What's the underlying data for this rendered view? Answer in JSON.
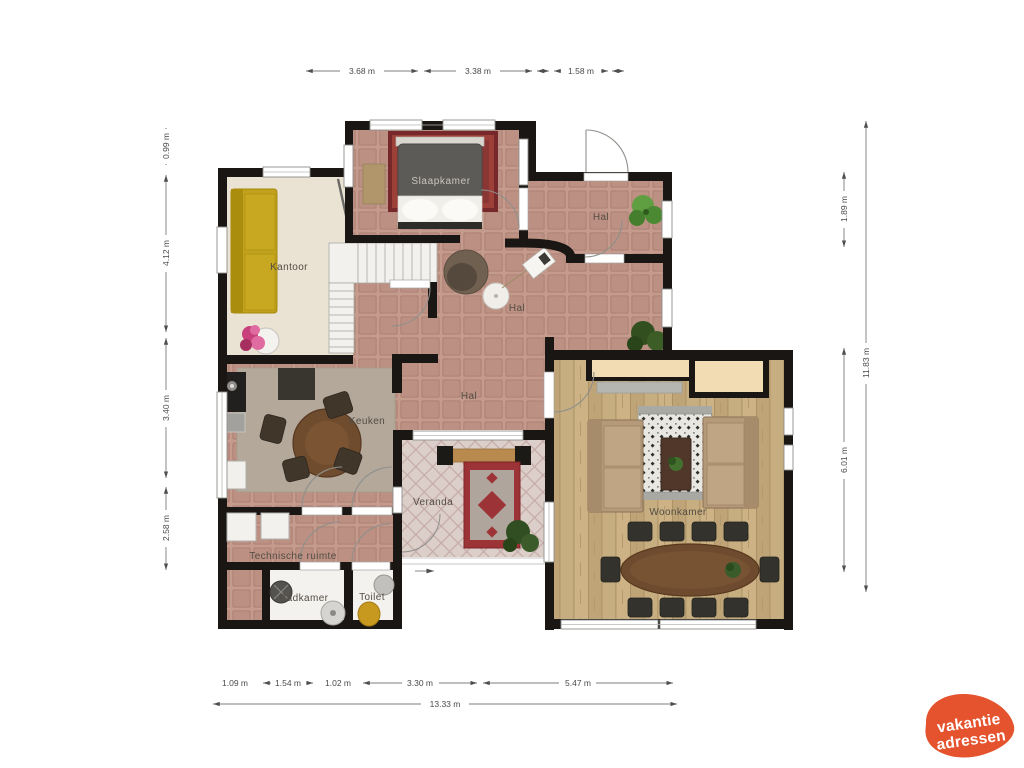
{
  "plan": {
    "rooms": {
      "slaapkamer": "Slaapkamer",
      "kantoor": "Kantoor",
      "hal_boven": "Hal",
      "hal_midden": "Hal",
      "hal_beneden": "Hal",
      "keuken": "Keuken",
      "veranda": "Veranda",
      "woonkamer": "Woonkamer",
      "technische_ruimte": "Technische ruimte",
      "badkamer": "Badkamer",
      "toilet": "Toilet"
    },
    "dimensions": {
      "top": [
        "3.68 m",
        "3.38 m",
        "1.58 m"
      ],
      "left": [
        "0.99 m",
        "4.12 m",
        "3.40 m",
        "2.58 m"
      ],
      "right_inner": [
        "1.89 m",
        "6.01 m"
      ],
      "right_outer": "11.83 m",
      "bottom": [
        "1.09 m",
        "1.54 m",
        "1.02 m",
        "3.30 m",
        "5.47 m"
      ],
      "bottom_total": "13.33 m"
    }
  },
  "logo": {
    "line1": "vakantie",
    "line2": "adressen",
    "color": "#e5532e"
  }
}
